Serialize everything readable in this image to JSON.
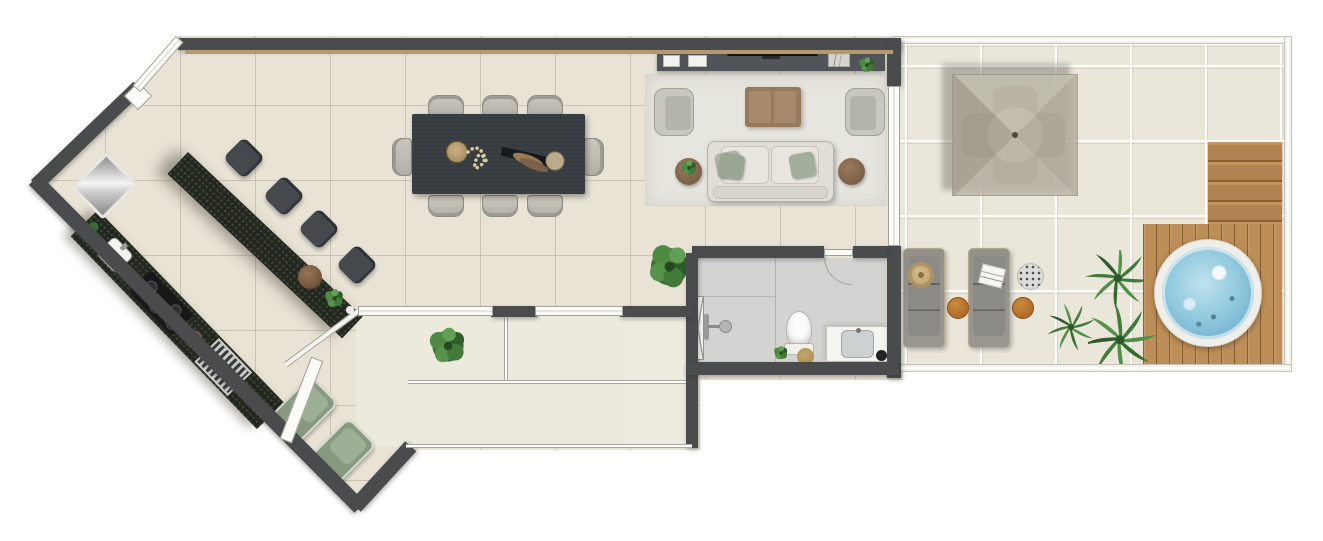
{
  "document": {
    "type": "architectural floor plan rendering",
    "view": "top-down",
    "visible_text": []
  },
  "colors": {
    "wall": "#4a4b4d",
    "wallWood": "#b49a6e",
    "floorMain": "#e9e3d6",
    "floorStairs": "#ece9dd",
    "floorBath": "#d3d4d2",
    "terraceFloor": "#eae6da",
    "rug": "#e6e5de",
    "tableDark": "#363b3f",
    "stoolDark": "#45494d",
    "sofaFabric": "#e0ded7",
    "woodFurniture": "#97795b",
    "greenLounger": "#87997f",
    "water": "#93cade",
    "deckWood": "#bd8e57",
    "plantGreen": "#3f7c3a",
    "glassWhite": "#fbfbf8"
  },
  "rooms": {
    "kitchen": {
      "label": "Kitchen",
      "items": [
        "refrigerator",
        "counter with sink",
        "cooktop with burners",
        "grill",
        "granite bar island",
        "4 bar stools",
        "decorative bowls"
      ]
    },
    "dining": {
      "label": "Dining area",
      "seats": 8,
      "items": [
        "rectangular dark dining table",
        "8 upholstered chairs",
        "centerpiece with beads, tray and spheres"
      ]
    },
    "living": {
      "label": "Living room",
      "items": [
        "TV console",
        "flat TV",
        "framed art",
        "2 white boxes",
        "sofa with 2 pillows",
        "2 armchairs",
        "wooden coffee table",
        "2 round side tables",
        "area rug",
        "potted plants"
      ]
    },
    "hallway": {
      "label": "Hallway",
      "items": [
        "large potted plant",
        "entry door"
      ]
    },
    "staircase": {
      "label": "Staircase",
      "upper_treads": 5,
      "lower_treads": 10,
      "items": [
        "U-shaped stair with landing",
        "glass rail",
        "potted plant"
      ]
    },
    "bathroom": {
      "label": "Bathroom",
      "items": [
        "walk-in shower with glass panel",
        "toilet",
        "vanity with sink",
        "small plant",
        "basket",
        "door"
      ]
    },
    "terrace": {
      "label": "Terrace / balcony",
      "items": [
        "square umbrella dining set with 4 chairs and round table",
        "2 sun loungers",
        "straw hat",
        "magazine",
        "2 orange side tables",
        "pebble planter",
        "palm plants",
        "wooden deck with steps",
        "round hot tub"
      ]
    }
  }
}
